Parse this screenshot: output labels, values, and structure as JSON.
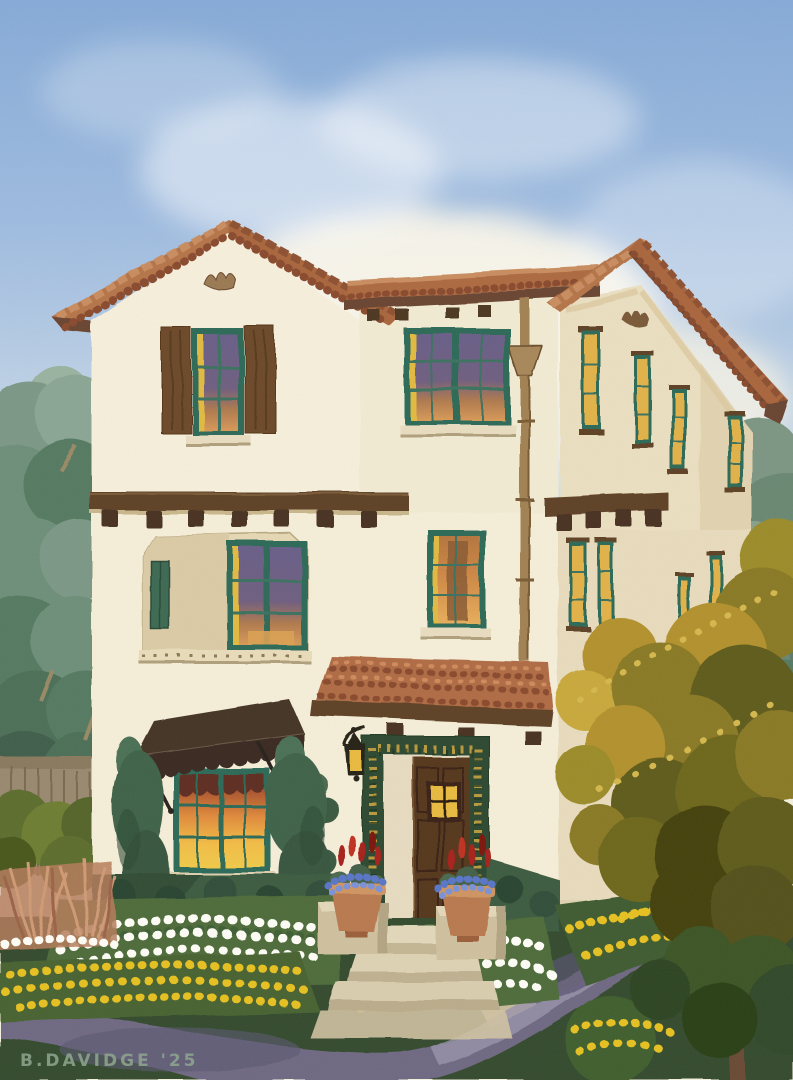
{
  "meta": {
    "medium": "watercolor architectural rendering",
    "subject": "Three-story Spanish Colonial Revival home with terracotta tile roofs, cream stucco walls, glowing amber windows, tiled entry surround, brown window awning, front garden with white and yellow flowers, curved violet sidewalk and golden tree"
  },
  "signature": {
    "text": "B.DAVIDGE '25",
    "color": "#8fa790"
  },
  "palette": {
    "sky_blue": "#84a9d6",
    "cloud_cream": "#f6f2e0",
    "stucco_cream": "#f6efdb",
    "stucco_shade": "#e9dcbd",
    "roof_terracotta": "#ad6a41",
    "roof_tile_light": "#c98d60",
    "roof_tile_shadow": "#8a4c2e",
    "roof_fascia_brown": "#6b4530",
    "wood_beam_brown": "#5f4226",
    "corbel_dark": "#4a3220",
    "shutter_brown": "#6d4a2b",
    "window_frame_teal": "#2f6a58",
    "window_glow_yellow": "#e2ba42",
    "window_glow_amber": "#e2b24a",
    "window_glow_orange": "#e08a3c",
    "window_violet": "#6a5e88",
    "door_brown": "#57381f",
    "tile_surround_green": "#2e4a30",
    "tile_surround_gold": "#c9a23e",
    "awning_brown": "#453528",
    "lantern_black": "#262019",
    "cypress_green": "#41644a",
    "hedge_green": "#3c5c40",
    "foliage_sage": "#7b9886",
    "tree_gold": "#b3912f",
    "tree_olive": "#8a7a26",
    "lawn_green": "#344b2d",
    "sidewalk_violet": "#6f6983",
    "sidewalk_light": "#9a93ab",
    "flower_white": "#fdfdf6",
    "flower_yellow": "#e6c121",
    "flower_red": "#a8221b",
    "flower_blue": "#5a76c8",
    "pot_terracotta": "#b97a4f",
    "step_cream": "#ddd1b2",
    "grass_coral": "#c68a6a",
    "fence_taupe": "#99896f"
  }
}
